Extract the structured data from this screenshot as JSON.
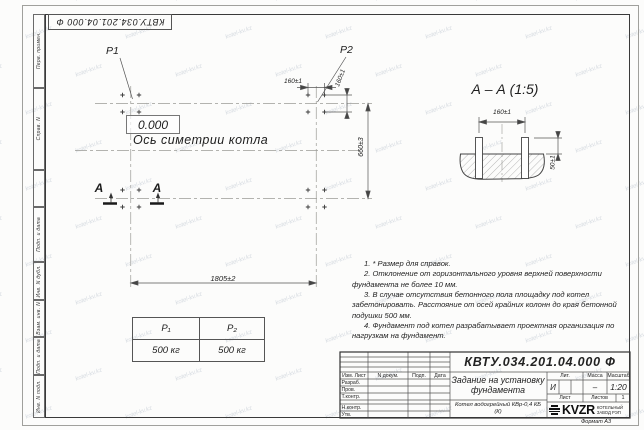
{
  "doc": {
    "designation": "КВТУ.034.201.04.000 Ф",
    "format_label": "Формат А3"
  },
  "frame": {
    "side_labels": [
      "Перв. примен.",
      "Справ. N",
      "Подп. и дата",
      "Инв. N дубл.",
      "Взам. инв. N",
      "Подп. и дата",
      "Инв. N подл."
    ]
  },
  "plan": {
    "p1_label": "P1",
    "p2_label": "P2",
    "level_label": "0.000",
    "axis_label": "Ось симетрии котла",
    "dim_width": "1805±2",
    "dim_height": "660±3",
    "dim_bolt_x": "160±1",
    "dim_bolt_y": "160±1",
    "section_letter_left": "А",
    "section_letter_right": "А"
  },
  "section": {
    "title": "А – А (1:5)",
    "dim_spacing": "160±1",
    "dim_protrusion": "50±1"
  },
  "load_table": {
    "headers": [
      "P₁",
      "P₂"
    ],
    "values": [
      "500 кг",
      "500 кг"
    ]
  },
  "notes": [
    "1. * Размер для справок.",
    "2. Отклонение от горизонтального уровня верхней поверхности фундамента не более 10 мм.",
    "3. В случае отсутствия бетонного пола площадку под котел забетонировать. Расстояние от осей крайних колонн до края бетонной подушки 500 мм.",
    "4. Фундамент под котел разрабатывает проектная организация по нагрузкам на фундамент."
  ],
  "title_block": {
    "columns": [
      "Изм. Лист",
      "N докум.",
      "Подп.",
      "Дата"
    ],
    "rows": [
      "Разраб.",
      "Пров.",
      "Т.контр.",
      "Н.контр.",
      "Утв."
    ],
    "title": "Задание на установку фундамента",
    "subtitle": "Котел водогрейный КВр-0,4 КБ (К)",
    "lit_header": "Лит.",
    "lit_value": "И",
    "mass_header": "Масса",
    "mass_value": "–",
    "scale_header": "Масштаб",
    "scale_value": "1:20",
    "sheet_label": "Лист",
    "sheets_label": "Листов",
    "sheets_value": "1",
    "logo_text": "KVZR",
    "logo_caption": "КОТЕЛЬНЫЙ ЗАВОД РЭП"
  },
  "watermark": {
    "text": "kotel-kv.kz"
  }
}
